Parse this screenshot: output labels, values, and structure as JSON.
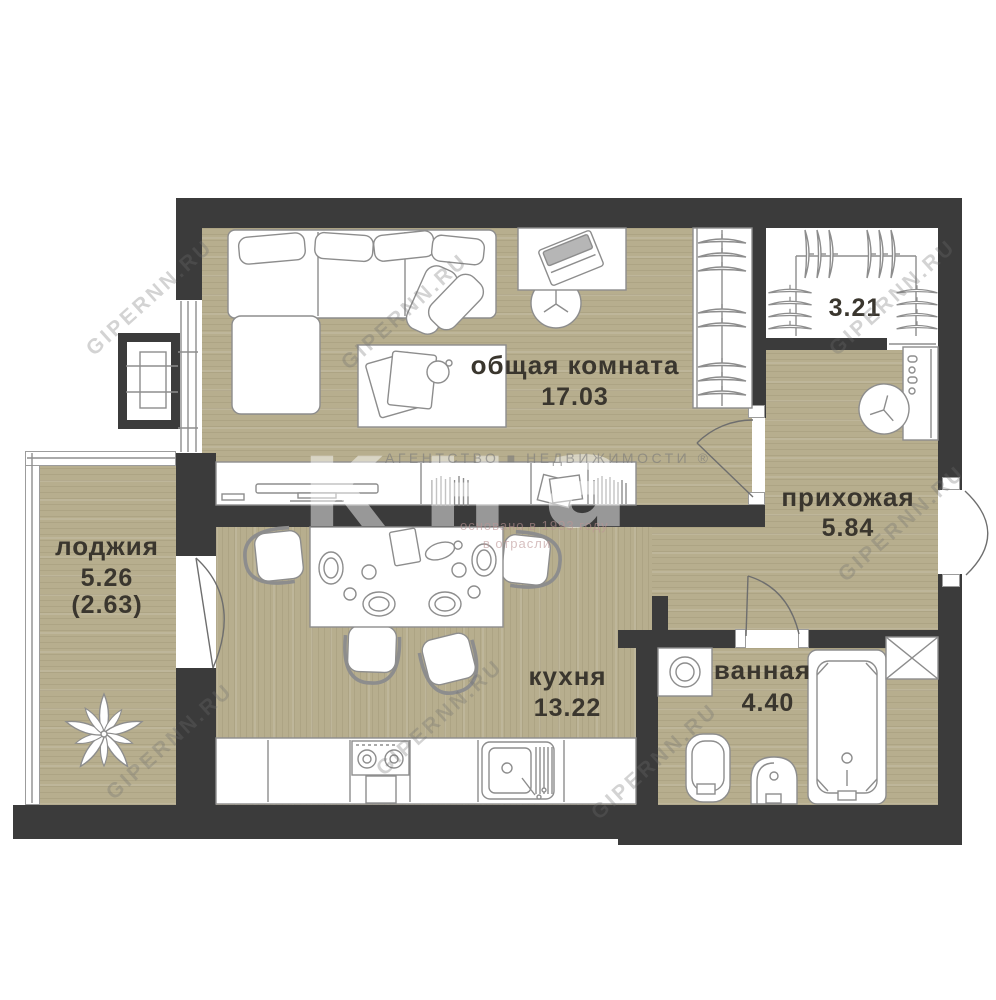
{
  "meta": {
    "type": "apartment-floor-plan"
  },
  "rooms": [
    {
      "key": "living",
      "name": "общая комната",
      "area": "17.03"
    },
    {
      "key": "closet",
      "name": "",
      "area": "3.21"
    },
    {
      "key": "hallway",
      "name": "прихожая",
      "area": "5.84"
    },
    {
      "key": "kitchen",
      "name": "кухня",
      "area": "13.22"
    },
    {
      "key": "bathroom",
      "name": "ванная",
      "area": "4.40"
    },
    {
      "key": "loggia",
      "name": "лоджия",
      "area": "5.26",
      "area_coefficient": "(2.63)"
    }
  ],
  "watermark": {
    "site": "GIPERNN.RU",
    "agency_line": "АГЕНТСТВО ■ НЕДВИЖИМОСТИ ®",
    "founded_line": "основано в 1993 году",
    "industry_line": "в отрасли",
    "logo_ghost": "кна"
  },
  "colors": {
    "wall": "#3b3b3b",
    "floor": "#b7ae8e",
    "label": "#3a362e",
    "line": "#8d8d8d"
  }
}
